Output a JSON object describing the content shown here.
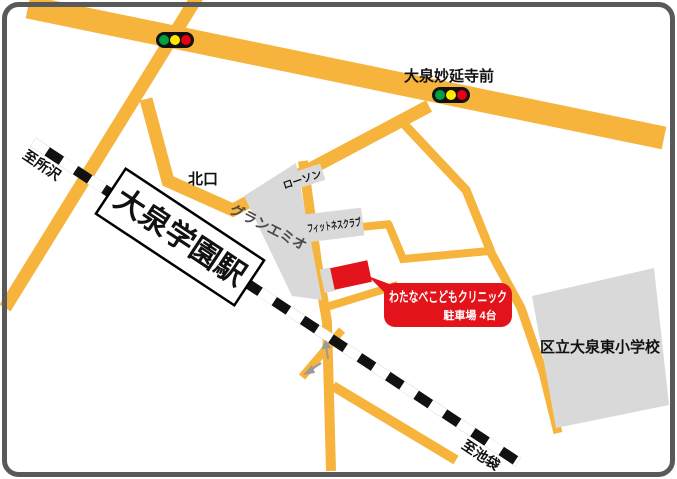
{
  "labels": {
    "station": "大泉学園駅",
    "north_exit": "北口",
    "to_tokorozawa": "至所沢",
    "to_ikebukuro": "至池袋",
    "signal_name": "大泉妙延寺前",
    "gran_emio": "グランエミオ",
    "lawson": "ローソン",
    "fitness_club": "フィットネスクラブ",
    "school": "区立大泉東小学校"
  },
  "clinic": {
    "name": "わたなべこどもクリニック",
    "parking": "駐車場 4台"
  },
  "icons": {
    "traffic_light": "traffic-light-icon (black bar with green/yellow/red lamps)",
    "railway": "railway-line-icon (black and white striped line)",
    "one_way_arrow": "one-way-arrow-icon (small gray arrow)"
  },
  "colors": {
    "road": "#F6B43C",
    "building": "#D9D9D9",
    "accent_red": "#E3131B",
    "railway": "#111111",
    "frame": "#595959",
    "signal_green": "#00A040",
    "signal_yellow": "#FFE800",
    "signal_red": "#E60012"
  }
}
